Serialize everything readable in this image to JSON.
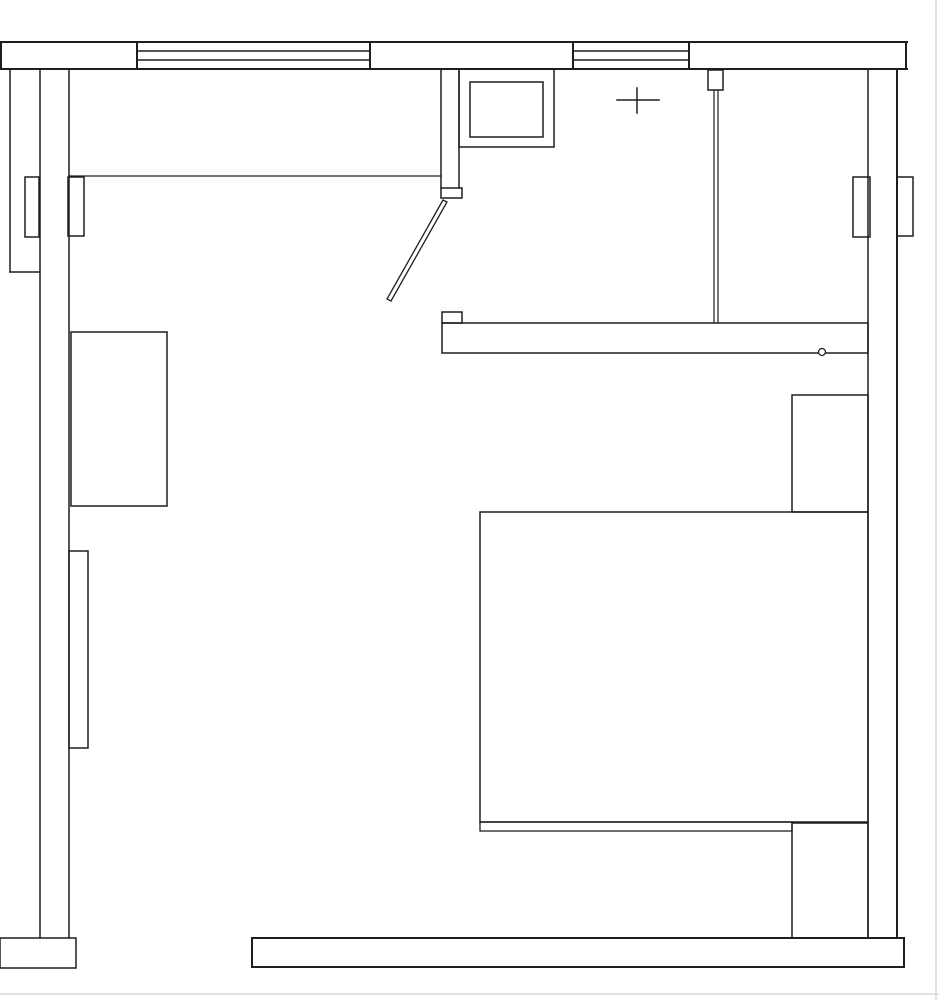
{
  "canvas": {
    "width": 939,
    "height": 1000,
    "background": "#ffffff",
    "line_color": "#1f1f1f",
    "artifact_color": "#d8d8d8",
    "fill_color": "#ffffff"
  },
  "drawing_type": "architectural floor plan, single room with bed, desk, door and windows, no text labels",
  "elements": [
    {
      "name": "scan-artifact-right-edge",
      "type": "line",
      "x1": 936,
      "y1": 0,
      "x2": 936,
      "y2": 1000,
      "sw": 1.5,
      "stroke": "artifact"
    },
    {
      "name": "scan-artifact-bottom-edge",
      "type": "line",
      "x1": 0,
      "y1": 994,
      "x2": 939,
      "y2": 994,
      "sw": 1.5,
      "stroke": "artifact"
    },
    {
      "name": "top-wall-outer-edge",
      "type": "line",
      "x1": 0,
      "y1": 42,
      "x2": 907,
      "y2": 42,
      "sw": 2
    },
    {
      "name": "top-wall-inner-edge",
      "type": "line",
      "x1": 0,
      "y1": 69,
      "x2": 907,
      "y2": 69,
      "sw": 2
    },
    {
      "name": "top-wall-left-end-cap",
      "type": "line",
      "x1": 1,
      "y1": 42,
      "x2": 1,
      "y2": 69,
      "sw": 2
    },
    {
      "name": "top-wall-right-end-cap",
      "type": "line",
      "x1": 906,
      "y1": 42,
      "x2": 906,
      "y2": 69,
      "sw": 2
    },
    {
      "name": "window-1-left-jamb",
      "type": "line",
      "x1": 137,
      "y1": 42,
      "x2": 137,
      "y2": 69,
      "sw": 2
    },
    {
      "name": "window-1-right-jamb",
      "type": "line",
      "x1": 370,
      "y1": 42,
      "x2": 370,
      "y2": 69,
      "sw": 2
    },
    {
      "name": "window-1-glazing-line-upper",
      "type": "line",
      "x1": 137,
      "y1": 51,
      "x2": 370,
      "y2": 51,
      "sw": 1.5
    },
    {
      "name": "window-1-glazing-line-lower",
      "type": "line",
      "x1": 137,
      "y1": 60,
      "x2": 370,
      "y2": 60,
      "sw": 1.5
    },
    {
      "name": "window-2-left-jamb",
      "type": "line",
      "x1": 573,
      "y1": 42,
      "x2": 573,
      "y2": 69,
      "sw": 2
    },
    {
      "name": "window-2-right-jamb",
      "type": "line",
      "x1": 689,
      "y1": 42,
      "x2": 689,
      "y2": 69,
      "sw": 2
    },
    {
      "name": "window-2-glazing-line-upper",
      "type": "line",
      "x1": 573,
      "y1": 51,
      "x2": 689,
      "y2": 51,
      "sw": 1.5
    },
    {
      "name": "window-2-glazing-line-lower",
      "type": "line",
      "x1": 573,
      "y1": 60,
      "x2": 689,
      "y2": 60,
      "sw": 1.5
    },
    {
      "name": "left-wall-outer-line",
      "type": "line",
      "x1": 10,
      "y1": 69,
      "x2": 10,
      "y2": 272,
      "sw": 1.5
    },
    {
      "name": "left-wall-outer-end-cap",
      "type": "line",
      "x1": 10,
      "y1": 272,
      "x2": 40,
      "y2": 272,
      "sw": 1.5
    },
    {
      "name": "left-wall-middle-line",
      "type": "line",
      "x1": 40,
      "y1": 69,
      "x2": 40,
      "y2": 938,
      "sw": 1.5
    },
    {
      "name": "left-wall-inner-line",
      "type": "line",
      "x1": 69,
      "y1": 69,
      "x2": 69,
      "y2": 938,
      "sw": 1.5
    },
    {
      "name": "right-wall-inner-line",
      "type": "line",
      "x1": 868,
      "y1": 69,
      "x2": 868,
      "y2": 938,
      "sw": 1.5
    },
    {
      "name": "right-wall-outer-line",
      "type": "line",
      "x1": 897,
      "y1": 69,
      "x2": 897,
      "y2": 938,
      "sw": 2
    },
    {
      "name": "left-window-outer-sash-box",
      "type": "rect",
      "x": 25,
      "y": 177,
      "w": 14,
      "h": 60,
      "sw": 1.5
    },
    {
      "name": "left-window-inner-sash-box",
      "type": "rect",
      "x": 68,
      "y": 177,
      "w": 16,
      "h": 59,
      "sw": 1.5
    },
    {
      "name": "right-window-inner-sash-box",
      "type": "rect",
      "x": 853,
      "y": 177,
      "w": 17,
      "h": 60,
      "sw": 1.5
    },
    {
      "name": "right-window-outer-sash-box",
      "type": "rect",
      "x": 897,
      "y": 177,
      "w": 16,
      "h": 59,
      "sw": 1.5
    },
    {
      "name": "counter-line",
      "type": "line",
      "x1": 69,
      "y1": 176,
      "x2": 441,
      "y2": 176,
      "sw": 1.3
    },
    {
      "name": "door-partition-left-line",
      "type": "line",
      "x1": 441,
      "y1": 69,
      "x2": 441,
      "y2": 188,
      "sw": 1.5
    },
    {
      "name": "door-partition-right-line",
      "type": "line",
      "x1": 459,
      "y1": 69,
      "x2": 459,
      "y2": 188,
      "sw": 1.5
    },
    {
      "name": "door-jamb-block",
      "type": "rect",
      "x": 441,
      "y": 188,
      "w": 21,
      "h": 10,
      "sw": 1.5
    },
    {
      "name": "door-leaf",
      "type": "polygon",
      "points": "443,200 387,299 391,301 447,202",
      "sw": 1.3,
      "fill": "white"
    },
    {
      "name": "stove-outer-box",
      "type": "rect",
      "x": 459,
      "y": 69,
      "w": 95,
      "h": 78,
      "sw": 1.5
    },
    {
      "name": "stove-inner-box",
      "type": "rect",
      "x": 470,
      "y": 82,
      "w": 73,
      "h": 55,
      "sw": 1.5
    },
    {
      "name": "light-symbol-cross-horizontal",
      "type": "line",
      "x1": 617,
      "y1": 100,
      "x2": 659,
      "y2": 100,
      "sw": 1.5
    },
    {
      "name": "light-symbol-cross-vertical",
      "type": "line",
      "x1": 637,
      "y1": 88,
      "x2": 637,
      "y2": 113,
      "sw": 1.5
    },
    {
      "name": "partition-wall-hanger-box",
      "type": "rect",
      "x": 708,
      "y": 70,
      "w": 15,
      "h": 20,
      "sw": 1.5
    },
    {
      "name": "partition-wall-line-a",
      "type": "line",
      "x1": 714,
      "y1": 90,
      "x2": 714,
      "y2": 323,
      "sw": 1.2
    },
    {
      "name": "partition-wall-line-b",
      "type": "line",
      "x1": 718,
      "y1": 90,
      "x2": 718,
      "y2": 323,
      "sw": 1.2
    },
    {
      "name": "wardrobe-band",
      "type": "rect",
      "x": 442,
      "y": 323,
      "w": 426,
      "h": 30,
      "sw": 1.5
    },
    {
      "name": "wardrobe-band-end-square",
      "type": "rect",
      "x": 442,
      "y": 312,
      "w": 20,
      "h": 11,
      "sw": 1.5
    },
    {
      "name": "wardrobe-knob-circle",
      "type": "circle",
      "cx": 822,
      "cy": 352,
      "r": 3.5,
      "sw": 1.3,
      "fill": "white"
    },
    {
      "name": "desk-rect",
      "type": "rect",
      "x": 71,
      "y": 332,
      "w": 96,
      "h": 174,
      "sw": 1.5
    },
    {
      "name": "left-radiator-rect",
      "type": "rect",
      "x": 69,
      "y": 551,
      "w": 19,
      "h": 197,
      "sw": 1.5
    },
    {
      "name": "nightstand-upper-rect",
      "type": "rect",
      "x": 792,
      "y": 395,
      "w": 76,
      "h": 117,
      "sw": 1.5
    },
    {
      "name": "bed-rect",
      "type": "rect",
      "x": 480,
      "y": 512,
      "w": 388,
      "h": 310,
      "sw": 1.5
    },
    {
      "name": "bed-footboard-strip",
      "type": "rect",
      "x": 480,
      "y": 822,
      "w": 312,
      "h": 9,
      "sw": 1.3
    },
    {
      "name": "nightstand-lower-rect",
      "type": "rect",
      "x": 792,
      "y": 823,
      "w": 76,
      "h": 115,
      "sw": 1.5
    },
    {
      "name": "bottom-wall",
      "type": "rect",
      "x": 252,
      "y": 938,
      "w": 652,
      "h": 29,
      "sw": 2
    },
    {
      "name": "bottom-left-wall-stub",
      "type": "rect",
      "x": 0,
      "y": 938,
      "w": 76,
      "h": 30,
      "sw": 1.5
    }
  ]
}
